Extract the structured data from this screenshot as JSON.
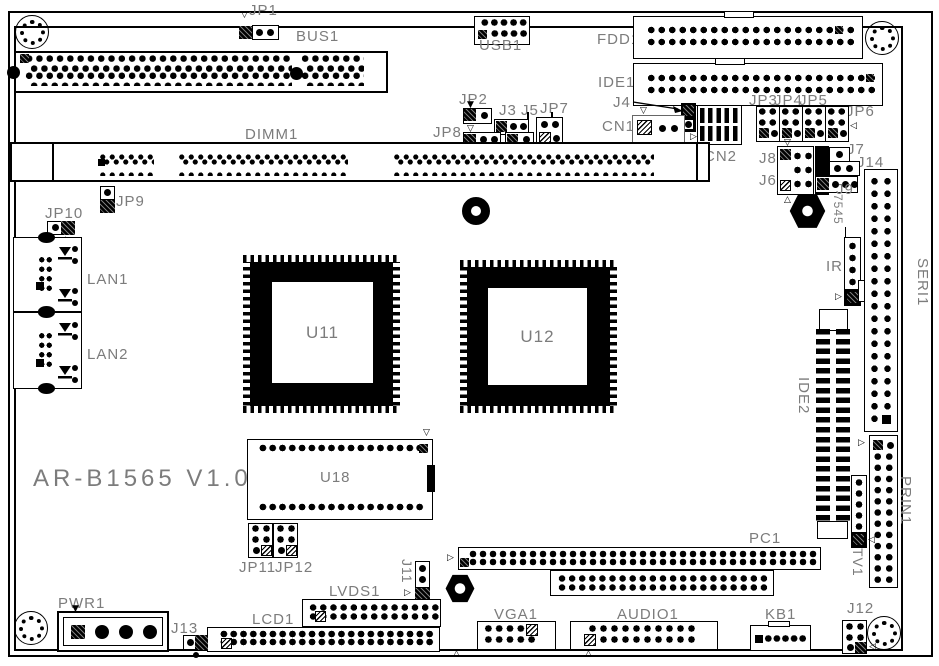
{
  "labels": {
    "title": "AR-B1565 V1.0",
    "jp1": "JP1",
    "bus1": "BUS1",
    "usb1": "USB1",
    "fdd1": "FDD1",
    "ide1": "IDE1",
    "jp2": "JP2",
    "j3": "J3",
    "j5": "J5",
    "jp7": "JP7",
    "jp8": "JP8",
    "j4": "J4",
    "cn1": "CN1",
    "cn2": "CN2",
    "jp3": "JP3",
    "jp4": "JP4",
    "jp5": "JP5",
    "jp6": "JP6",
    "j8": "J8",
    "j6": "J6",
    "j7": "J7",
    "j14": "J14",
    "j9": "J9",
    "dimm1": "DIMM1",
    "jp9": "JP9",
    "jp10": "JP10",
    "lan1": "LAN1",
    "lan2": "LAN2",
    "u11": "U11",
    "u12": "U12",
    "u18": "U18",
    "jp11": "JP11",
    "jp12": "JP12",
    "j11": "J11",
    "lvds1": "LVDS1",
    "lcd1": "LCD1",
    "pwr1": "PWR1",
    "j13": "J13",
    "vga1": "VGA1",
    "audio1": "AUDIO1",
    "kb1": "KB1",
    "j12": "J12",
    "pc1": "PC1",
    "tv1": "TV1",
    "prin1": "PRIN1",
    "seri1": "SERI1",
    "ide2": "IDE2",
    "ir1": "IR1",
    "c7545": "7545"
  },
  "icons": {
    "tri_down": "▽",
    "tri_up": "△",
    "tri_right": "▷",
    "tri_left": "◁",
    "solid_down": "▼",
    "solid_up": "▲"
  },
  "colors": {
    "silkscreen": "#000000",
    "label_gray": "#7c7c7c",
    "board": "#ffffff"
  }
}
